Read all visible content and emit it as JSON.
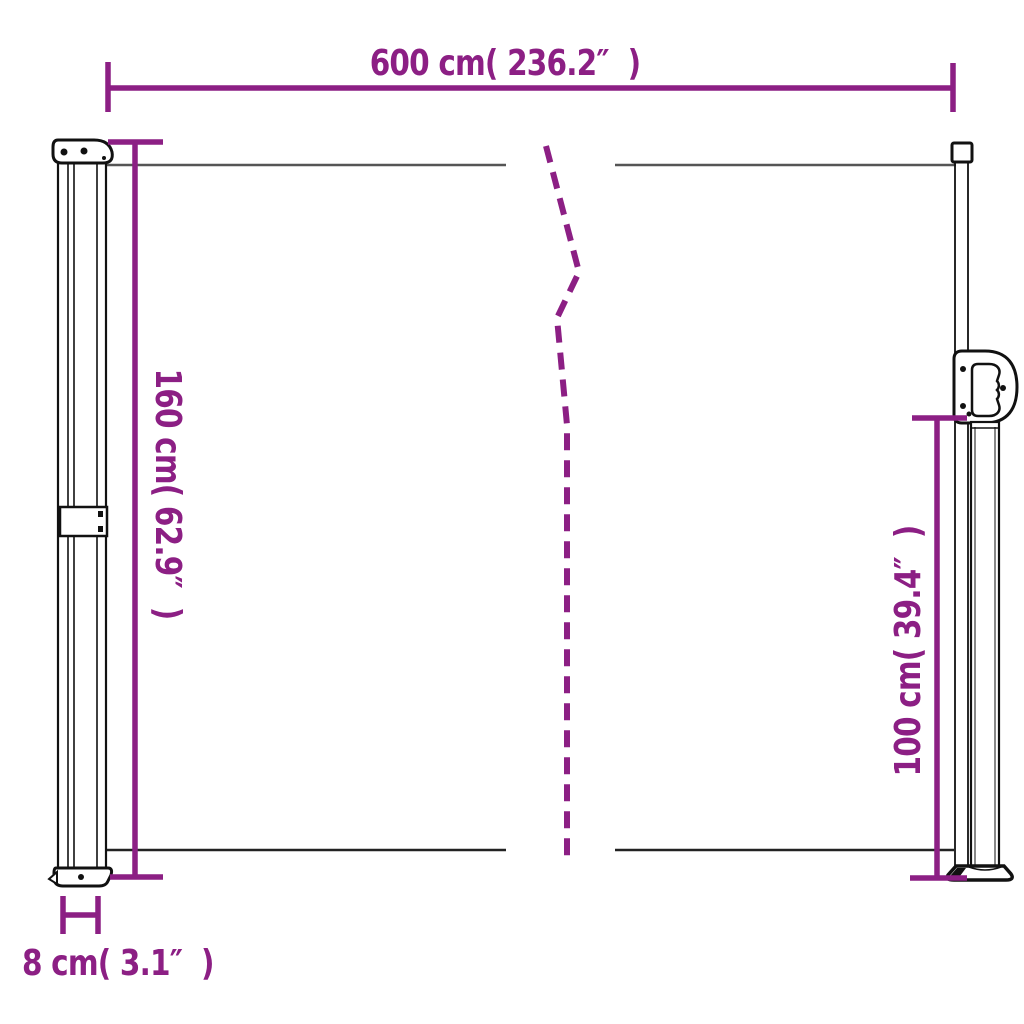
{
  "diagram": {
    "colors": {
      "accent": "#8C1F84",
      "line": "#555555",
      "line_dark": "#222222",
      "outline": "#111111"
    },
    "dimensions": {
      "width": {
        "label": "600 cm( 236.2″  )",
        "cm": 600,
        "inches": 236.2
      },
      "height_left": {
        "label": "160 cm( 62.9″  )",
        "cm": 160,
        "inches": 62.9
      },
      "height_right": {
        "label": "100 cm( 39.4″  )",
        "cm": 100,
        "inches": 39.4
      },
      "depth": {
        "label": "8 cm( 3.1″  )",
        "cm": 8,
        "inches": 3.1
      }
    }
  }
}
